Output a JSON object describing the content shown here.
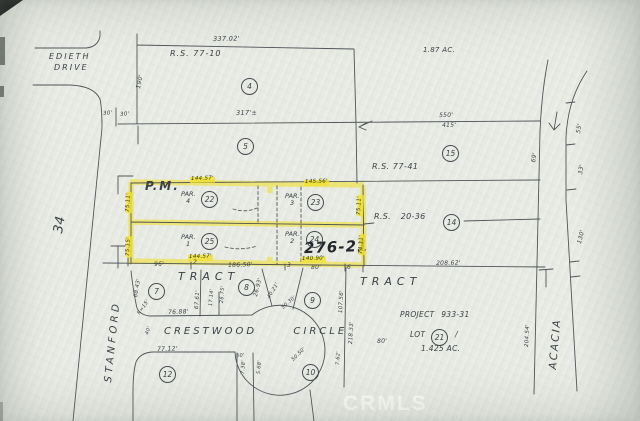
{
  "watermark": "CRMLS",
  "map_number": "276-21",
  "streets": {
    "edieth1": "EDIETH",
    "edieth2": "DRIVE",
    "stanford": "STANFORD",
    "crestwood": "CRESTWOOD  CIRCLE",
    "acacia": "ACACIA"
  },
  "annotations": {
    "pm": "P.M.",
    "rs_77_10": "R.S. 77-10",
    "rs_77_41": "R.S. 77-41",
    "rs_20_36": "R.S. 20-36",
    "tract_west": "TRACT",
    "tract_east": "TRACT",
    "section": "34",
    "area_ne": "1.87 AC.",
    "project": "PROJECT 933-31",
    "lot": "LOT",
    "lot_slash": "/",
    "lot_area": "1.425 AC."
  },
  "lot_circles": [
    {
      "n": "4",
      "x": 241,
      "y": 78
    },
    {
      "n": "5",
      "x": 237,
      "y": 138
    },
    {
      "n": "15",
      "x": 442,
      "y": 145
    },
    {
      "n": "14",
      "x": 443,
      "y": 214
    },
    {
      "n": "22",
      "x": 201,
      "y": 191
    },
    {
      "n": "23",
      "x": 307,
      "y": 194
    },
    {
      "n": "24",
      "x": 306,
      "y": 231
    },
    {
      "n": "25",
      "x": 201,
      "y": 233
    },
    {
      "n": "7",
      "x": 148,
      "y": 283
    },
    {
      "n": "8",
      "x": 238,
      "y": 279
    },
    {
      "n": "9",
      "x": 304,
      "y": 292
    },
    {
      "n": "21",
      "x": 431,
      "y": 329
    },
    {
      "n": "10",
      "x": 302,
      "y": 364
    },
    {
      "n": "12",
      "x": 159,
      "y": 366
    }
  ],
  "parcel_labels": [
    {
      "l1": "PAR.",
      "l2": "4",
      "x": 181,
      "y": 191
    },
    {
      "l1": "PAR.",
      "l2": "3",
      "x": 285,
      "y": 193
    },
    {
      "l1": "PAR.",
      "l2": "1",
      "x": 181,
      "y": 234
    },
    {
      "l1": "PAR.",
      "l2": "2",
      "x": 285,
      "y": 231
    }
  ],
  "dimensions": [
    {
      "t": "337.02'",
      "x": 213,
      "y": 36,
      "r": -1,
      "s": 6.5
    },
    {
      "t": "190'",
      "x": 136,
      "y": 88,
      "r": -78,
      "s": 6
    },
    {
      "t": "30'",
      "x": 103,
      "y": 112,
      "r": -5,
      "s": 5.5
    },
    {
      "t": "30'",
      "x": 120,
      "y": 113,
      "r": -5,
      "s": 5.5
    },
    {
      "t": "317'±",
      "x": 236,
      "y": 110,
      "r": -1,
      "s": 6.5
    },
    {
      "t": "550'",
      "x": 439,
      "y": 113,
      "r": -1,
      "s": 6
    },
    {
      "t": "415'",
      "x": 442,
      "y": 123,
      "r": -1,
      "s": 6
    },
    {
      "t": "69'",
      "x": 531,
      "y": 162,
      "r": -80,
      "s": 6
    },
    {
      "t": "55'",
      "x": 576,
      "y": 133,
      "r": -80,
      "s": 6
    },
    {
      "t": "33'",
      "x": 578,
      "y": 174,
      "r": -80,
      "s": 6
    },
    {
      "t": "130'",
      "x": 577,
      "y": 243,
      "r": -76,
      "s": 6
    },
    {
      "t": "144.57'",
      "x": 190,
      "y": 177,
      "r": -1,
      "s": 5.5,
      "hl": true
    },
    {
      "t": "145.56'",
      "x": 304,
      "y": 180,
      "r": -1,
      "s": 5.5,
      "hl": true
    },
    {
      "t": "75.11'",
      "x": 126,
      "y": 213,
      "r": -88,
      "s": 5.5,
      "hl": true
    },
    {
      "t": "75.15'",
      "x": 126,
      "y": 257,
      "r": -88,
      "s": 5.5,
      "hl": true
    },
    {
      "t": "75.11'",
      "x": 357,
      "y": 216,
      "r": -88,
      "s": 5.5,
      "hl": true
    },
    {
      "t": "74.11'",
      "x": 359,
      "y": 255,
      "r": -88,
      "s": 5.5,
      "hl": true
    },
    {
      "t": "144.57'",
      "x": 188,
      "y": 255,
      "r": -1,
      "s": 5.5,
      "hl": true
    },
    {
      "t": "140.90'",
      "x": 301,
      "y": 257,
      "r": -1,
      "s": 5.5,
      "hl": true
    },
    {
      "t": "96'",
      "x": 154,
      "y": 262,
      "r": -2,
      "s": 6
    },
    {
      "t": "2",
      "x": 193,
      "y": 260,
      "r": 0,
      "s": 6
    },
    {
      "t": "186.50'",
      "x": 228,
      "y": 263,
      "r": -2,
      "s": 6
    },
    {
      "t": "3",
      "x": 287,
      "y": 263,
      "r": 0,
      "s": 6
    },
    {
      "t": "80'",
      "x": 311,
      "y": 265,
      "r": 0,
      "s": 6
    },
    {
      "t": "6",
      "x": 347,
      "y": 265,
      "r": 0,
      "s": 6
    },
    {
      "t": "208.62'",
      "x": 436,
      "y": 261,
      "r": -1,
      "s": 6
    },
    {
      "t": "68.43'",
      "x": 134,
      "y": 297,
      "r": -80,
      "s": 5.5
    },
    {
      "t": "R=15'",
      "x": 137,
      "y": 313,
      "r": -55,
      "s": 5
    },
    {
      "t": "76.88'",
      "x": 168,
      "y": 310,
      "r": -2,
      "s": 6
    },
    {
      "t": "67.61'",
      "x": 195,
      "y": 309,
      "r": -86,
      "s": 5.5
    },
    {
      "t": "17.14'",
      "x": 209,
      "y": 306,
      "r": -86,
      "s": 5
    },
    {
      "t": "26.75'",
      "x": 220,
      "y": 303,
      "r": -86,
      "s": 5
    },
    {
      "t": "26.93'",
      "x": 254,
      "y": 296,
      "r": -76,
      "s": 5.5
    },
    {
      "t": "40.21'",
      "x": 267,
      "y": 297,
      "r": -58,
      "s": 5
    },
    {
      "t": "50.30'",
      "x": 281,
      "y": 307,
      "r": -42,
      "s": 5
    },
    {
      "t": "107.56'",
      "x": 339,
      "y": 313,
      "r": -87,
      "s": 5.5
    },
    {
      "t": "218.33'",
      "x": 349,
      "y": 344,
      "r": -87,
      "s": 5.5
    },
    {
      "t": "7.62'",
      "x": 336,
      "y": 365,
      "r": -87,
      "s": 5
    },
    {
      "t": "77.12'",
      "x": 157,
      "y": 347,
      "r": -2,
      "s": 6
    },
    {
      "t": "40'",
      "x": 145,
      "y": 334,
      "r": -70,
      "s": 5
    },
    {
      "t": "50'",
      "x": 236,
      "y": 354,
      "r": -3,
      "s": 5
    },
    {
      "t": "7.38'",
      "x": 241,
      "y": 374,
      "r": -86,
      "s": 5
    },
    {
      "t": "5.68'",
      "x": 257,
      "y": 374,
      "r": -86,
      "s": 5
    },
    {
      "t": "50.50'",
      "x": 291,
      "y": 359,
      "r": -44,
      "s": 5
    },
    {
      "t": "80'",
      "x": 377,
      "y": 339,
      "r": -2,
      "s": 6
    },
    {
      "t": "204.54'",
      "x": 525,
      "y": 347,
      "r": -87,
      "s": 5.5
    }
  ]
}
